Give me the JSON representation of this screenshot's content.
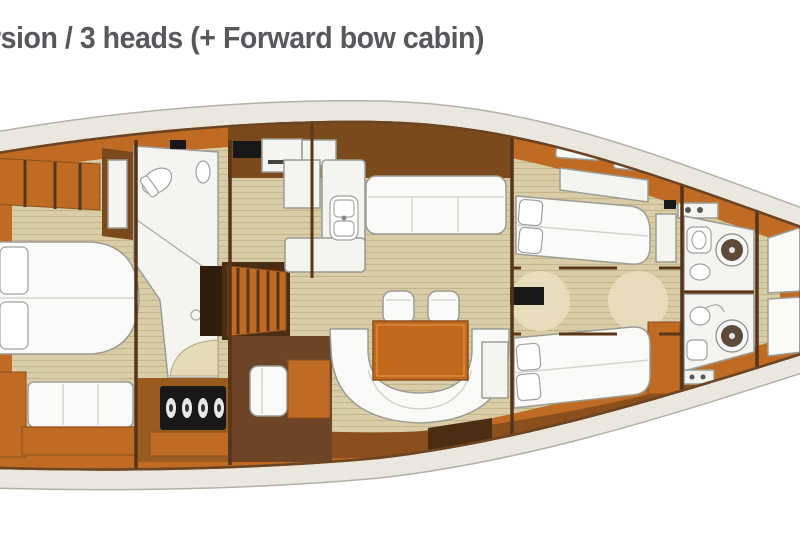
{
  "title": "rsion / 3 heads (+ Forward bow cabin)",
  "figure": {
    "type": "sailing-yacht-interior-floor-plan",
    "orientation": "bow-right"
  },
  "colors": {
    "title_text": "#57585c",
    "hull_deck": "#e9e7de",
    "hull_outline": "#b3b1a5",
    "wood_orange": "#bf6b24",
    "wood_orange_dark": "#8a4f1d",
    "wood_dark": "#7a4a1c",
    "wood_deep": "#4a2d12",
    "floor_tan": "#d9cda7",
    "floor_line": "#c2b48b",
    "fixture_white": "#f4f4f1",
    "fixture_stroke": "#9c9c94",
    "bed_white": "#fafaf8",
    "panel_black": "#181818",
    "table_orange": "#c2691e",
    "shower_brown": "#5d4a38"
  }
}
